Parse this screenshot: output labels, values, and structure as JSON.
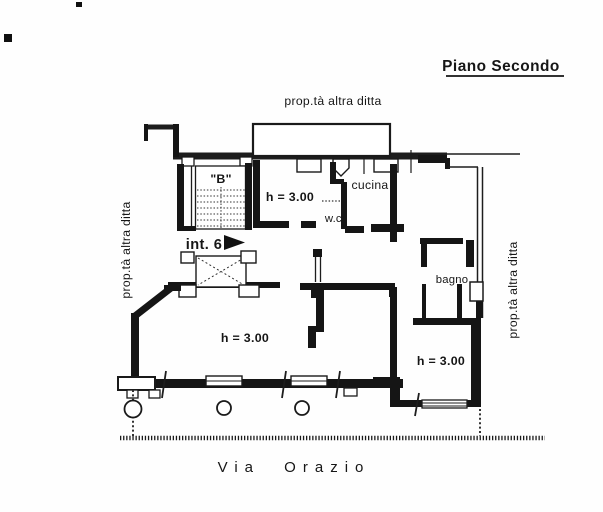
{
  "page": {
    "title": "Piano Secondo",
    "street_name": "Via  Orazio"
  },
  "boundaries": {
    "top_label": "prop.tà altra ditta",
    "left_label": "prop.tà altra ditta",
    "right_label": "prop.tà altra ditta"
  },
  "plan": {
    "stairwell_label": "\"B\"",
    "entrance_label": "int. 6",
    "kitchen_label": "cucina",
    "wc_label": "w.c.",
    "bathroom_label": "bagno",
    "height_room_top": "h = 3.00",
    "height_living": "h = 3.00",
    "height_bedroom": "h = 3.00"
  }
}
